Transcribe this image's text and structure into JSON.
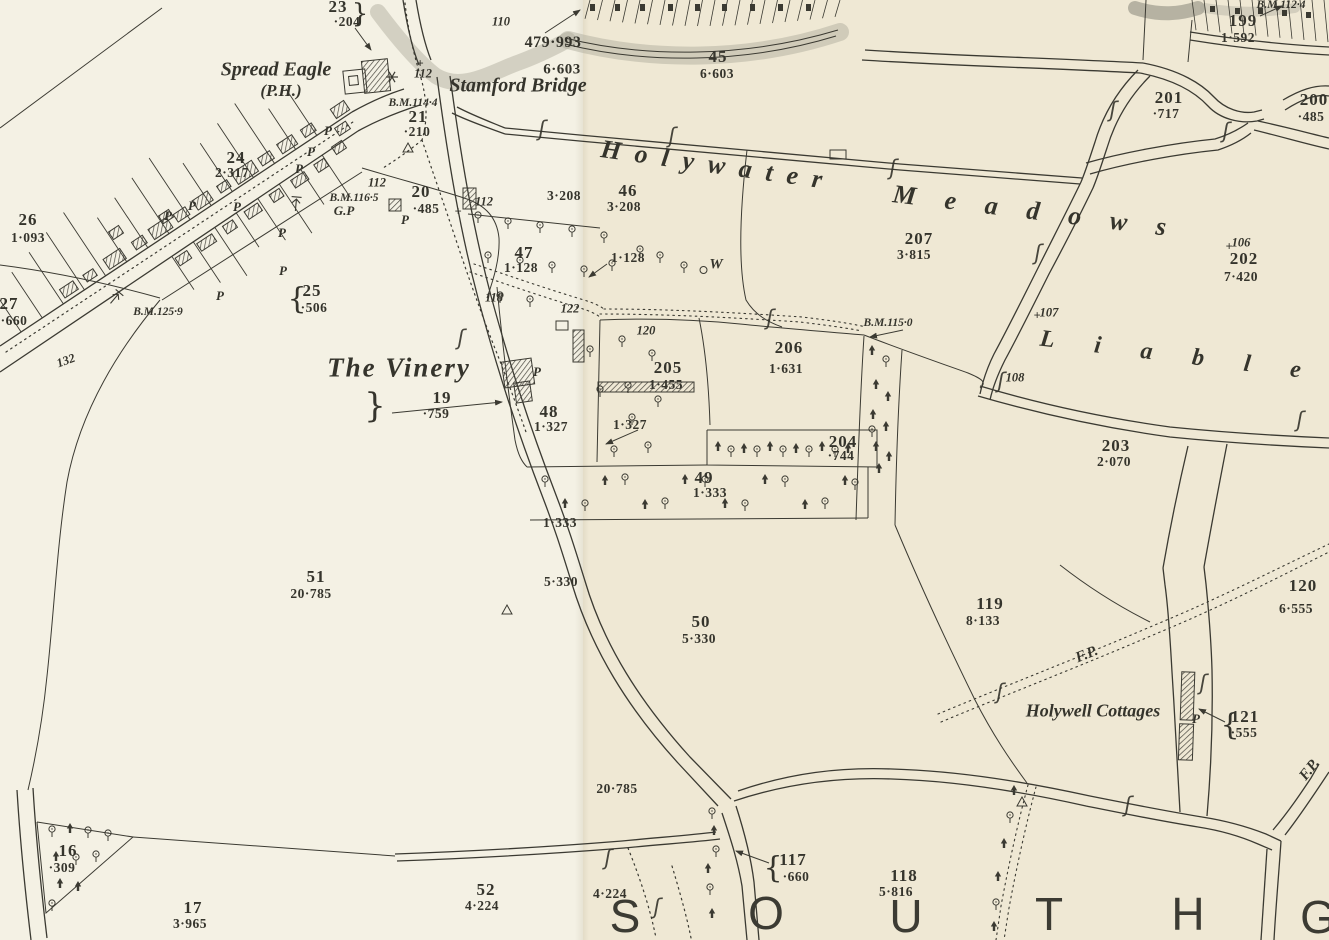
{
  "map": {
    "sheet_colors": {
      "left_paper": "#f4f1e4",
      "right_paper": "#efe8d4",
      "ink": "#3b3a32",
      "grey_wash": "#a9a79a"
    },
    "labels": [
      {
        "t": "23",
        "x": 338,
        "y": 7,
        "c": "parcel"
      },
      {
        "t": "·204",
        "x": 347,
        "y": 22,
        "c": "acre"
      },
      {
        "t": "}",
        "x": 360,
        "y": 14,
        "c": "brace"
      },
      {
        "t": "24",
        "x": 236,
        "y": 158,
        "c": "parcel"
      },
      {
        "t": "2·317",
        "x": 232,
        "y": 173,
        "c": "acre"
      },
      {
        "t": "26",
        "x": 28,
        "y": 220,
        "c": "parcel"
      },
      {
        "t": "1·093",
        "x": 28,
        "y": 238,
        "c": "acre"
      },
      {
        "t": "27",
        "x": 9,
        "y": 304,
        "c": "parcel"
      },
      {
        "t": "·660",
        "x": 14,
        "y": 321,
        "c": "acre"
      },
      {
        "t": "{",
        "x": 297,
        "y": 299,
        "c": "brace",
        "fs": 30
      },
      {
        "t": "25",
        "x": 312,
        "y": 291,
        "c": "parcel"
      },
      {
        "t": "·506",
        "x": 314,
        "y": 308,
        "c": "acre"
      },
      {
        "t": "21",
        "x": 418,
        "y": 117,
        "c": "parcel"
      },
      {
        "t": "·210",
        "x": 417,
        "y": 132,
        "c": "acre"
      },
      {
        "t": "20",
        "x": 421,
        "y": 192,
        "c": "parcel"
      },
      {
        "t": "·485",
        "x": 426,
        "y": 209,
        "c": "acre"
      },
      {
        "t": "19",
        "x": 442,
        "y": 398,
        "c": "parcel"
      },
      {
        "t": "·759",
        "x": 436,
        "y": 414,
        "c": "acre"
      },
      {
        "t": "}",
        "x": 375,
        "y": 406,
        "c": "brace",
        "fs": 34
      },
      {
        "t": "45",
        "x": 718,
        "y": 57,
        "c": "parcel"
      },
      {
        "t": "6·603",
        "x": 717,
        "y": 74,
        "c": "acre"
      },
      {
        "t": "46",
        "x": 628,
        "y": 191,
        "c": "parcel"
      },
      {
        "t": "3·208",
        "x": 624,
        "y": 207,
        "c": "acre"
      },
      {
        "t": "47",
        "x": 524,
        "y": 253,
        "c": "parcel"
      },
      {
        "t": "1·128",
        "x": 521,
        "y": 268,
        "c": "acre"
      },
      {
        "t": "48",
        "x": 549,
        "y": 412,
        "c": "parcel"
      },
      {
        "t": "1·327",
        "x": 551,
        "y": 427,
        "c": "acre"
      },
      {
        "t": "49",
        "x": 704,
        "y": 478,
        "c": "parcel"
      },
      {
        "t": "1·333",
        "x": 710,
        "y": 493,
        "c": "acre"
      },
      {
        "t": "50",
        "x": 701,
        "y": 622,
        "c": "parcel"
      },
      {
        "t": "5·330",
        "x": 699,
        "y": 639,
        "c": "acre"
      },
      {
        "t": "51",
        "x": 316,
        "y": 577,
        "c": "parcel"
      },
      {
        "t": "20·785",
        "x": 311,
        "y": 594,
        "c": "acre"
      },
      {
        "t": "52",
        "x": 486,
        "y": 890,
        "c": "parcel"
      },
      {
        "t": "4·224",
        "x": 482,
        "y": 906,
        "c": "acre"
      },
      {
        "t": "16",
        "x": 68,
        "y": 851,
        "c": "parcel"
      },
      {
        "t": "·309",
        "x": 62,
        "y": 868,
        "c": "acre"
      },
      {
        "t": "17",
        "x": 193,
        "y": 908,
        "c": "parcel"
      },
      {
        "t": "3·965",
        "x": 190,
        "y": 924,
        "c": "acre"
      },
      {
        "t": "{",
        "x": 773,
        "y": 868,
        "c": "brace",
        "fs": 30
      },
      {
        "t": "117",
        "x": 793,
        "y": 860,
        "c": "parcel"
      },
      {
        "t": "·660",
        "x": 796,
        "y": 877,
        "c": "acre"
      },
      {
        "t": "118",
        "x": 904,
        "y": 876,
        "c": "parcel"
      },
      {
        "t": "5·816",
        "x": 896,
        "y": 892,
        "c": "acre"
      },
      {
        "t": "119",
        "x": 990,
        "y": 604,
        "c": "parcel"
      },
      {
        "t": "8·133",
        "x": 983,
        "y": 621,
        "c": "acre"
      },
      {
        "t": "120",
        "x": 1303,
        "y": 586,
        "c": "parcel"
      },
      {
        "t": "6·555",
        "x": 1296,
        "y": 609,
        "c": "acre"
      },
      {
        "t": "{",
        "x": 1230,
        "y": 725,
        "c": "brace",
        "fs": 30
      },
      {
        "t": "121",
        "x": 1245,
        "y": 717,
        "c": "parcel"
      },
      {
        "t": "·555",
        "x": 1244,
        "y": 733,
        "c": "acre"
      },
      {
        "t": "199",
        "x": 1243,
        "y": 21,
        "c": "parcel"
      },
      {
        "t": "1·592",
        "x": 1238,
        "y": 38,
        "c": "acre"
      },
      {
        "t": "200",
        "x": 1314,
        "y": 100,
        "c": "parcel"
      },
      {
        "t": "·485",
        "x": 1311,
        "y": 117,
        "c": "acre"
      },
      {
        "t": "201",
        "x": 1169,
        "y": 98,
        "c": "parcel"
      },
      {
        "t": "·717",
        "x": 1166,
        "y": 114,
        "c": "acre"
      },
      {
        "t": "202",
        "x": 1244,
        "y": 259,
        "c": "parcel"
      },
      {
        "t": "7·420",
        "x": 1241,
        "y": 277,
        "c": "acre"
      },
      {
        "t": "203",
        "x": 1116,
        "y": 446,
        "c": "parcel"
      },
      {
        "t": "2·070",
        "x": 1114,
        "y": 462,
        "c": "acre"
      },
      {
        "t": "204",
        "x": 843,
        "y": 442,
        "c": "parcel"
      },
      {
        "t": "·744",
        "x": 841,
        "y": 456,
        "c": "acre"
      },
      {
        "t": "205",
        "x": 668,
        "y": 368,
        "c": "parcel"
      },
      {
        "t": "1·455",
        "x": 666,
        "y": 385,
        "c": "acre"
      },
      {
        "t": "206",
        "x": 789,
        "y": 348,
        "c": "parcel"
      },
      {
        "t": "1·631",
        "x": 786,
        "y": 369,
        "c": "acre"
      },
      {
        "t": "207",
        "x": 919,
        "y": 239,
        "c": "parcel"
      },
      {
        "t": "3·815",
        "x": 914,
        "y": 255,
        "c": "acre"
      },
      {
        "t": "479·993",
        "x": 553,
        "y": 43,
        "c": "acre",
        "fs": 16
      },
      {
        "t": "6·603",
        "x": 562,
        "y": 70,
        "c": "acre",
        "fs": 15
      },
      {
        "t": "3·208",
        "x": 564,
        "y": 196,
        "c": "acre"
      },
      {
        "t": "1·128",
        "x": 628,
        "y": 258,
        "c": "acre"
      },
      {
        "t": "1·327",
        "x": 630,
        "y": 425,
        "c": "acre"
      },
      {
        "t": "1·333",
        "x": 560,
        "y": 523,
        "c": "acre"
      },
      {
        "t": "5·330",
        "x": 561,
        "y": 582,
        "c": "acre"
      },
      {
        "t": "20·785",
        "x": 617,
        "y": 789,
        "c": "acre"
      },
      {
        "t": "4·224",
        "x": 610,
        "y": 894,
        "c": "acre"
      },
      {
        "t": "B.M.114·4",
        "x": 413,
        "y": 103,
        "c": "bm"
      },
      {
        "t": "B.M.116·5",
        "x": 354,
        "y": 198,
        "c": "bm"
      },
      {
        "t": "B.M.125·9",
        "x": 158,
        "y": 312,
        "c": "bm"
      },
      {
        "t": "B.M.115·0",
        "x": 888,
        "y": 323,
        "c": "bm"
      },
      {
        "t": "B.M.112·4",
        "x": 1281,
        "y": 5,
        "c": "bm"
      },
      {
        "t": "110",
        "x": 501,
        "y": 22,
        "c": "rd"
      },
      {
        "t": "112",
        "x": 423,
        "y": 74,
        "c": "rd"
      },
      {
        "t": "112",
        "x": 377,
        "y": 183,
        "c": "rd"
      },
      {
        "t": "112",
        "x": 484,
        "y": 202,
        "c": "rd"
      },
      {
        "t": "118",
        "x": 494,
        "y": 298,
        "c": "rd"
      },
      {
        "t": "122",
        "x": 570,
        "y": 309,
        "c": "rd"
      },
      {
        "t": "120",
        "x": 646,
        "y": 331,
        "c": "rd"
      },
      {
        "t": "132",
        "x": 66,
        "y": 361,
        "c": "rd",
        "r": -20
      },
      {
        "t": "106",
        "x": 1241,
        "y": 243,
        "c": "rd"
      },
      {
        "t": "107",
        "x": 1049,
        "y": 313,
        "c": "rd"
      },
      {
        "t": "108",
        "x": 1015,
        "y": 378,
        "c": "rd"
      },
      {
        "t": "+",
        "x": 1229,
        "y": 247,
        "c": "rd"
      },
      {
        "t": "+",
        "x": 1037,
        "y": 316,
        "c": "rd"
      },
      {
        "t": "+",
        "x": 458,
        "y": 212,
        "c": "rd"
      },
      {
        "t": "+",
        "x": 420,
        "y": 64,
        "c": "rd"
      },
      {
        "t": "Spread Eagle",
        "x": 276,
        "y": 70,
        "c": "place"
      },
      {
        "t": "(P.H.)",
        "x": 281,
        "y": 91,
        "c": "place",
        "fs": 17
      },
      {
        "t": "Stamford Bridge",
        "x": 518,
        "y": 86,
        "c": "place"
      },
      {
        "t": "The Vinery",
        "x": 399,
        "y": 368,
        "c": "place-lg"
      },
      {
        "t": "Holywell Cottages",
        "x": 1093,
        "y": 711,
        "c": "place",
        "fs": 18
      },
      {
        "t": "F.P.",
        "x": 1087,
        "y": 655,
        "c": "place-sm",
        "r": -22
      },
      {
        "t": "F.P.",
        "x": 1310,
        "y": 770,
        "c": "place-sm",
        "r": -52
      },
      {
        "t": "Holywater",
        "x": 601,
        "y": 149,
        "c": "spread",
        "a": "l",
        "r": 8,
        "ls": 14
      },
      {
        "t": "Meadows",
        "x": 893,
        "y": 194,
        "c": "spread",
        "a": "l",
        "r": 7,
        "ls": 29
      },
      {
        "t": "Liable",
        "x": 1040,
        "y": 339,
        "c": "spread",
        "a": "l",
        "r": 7,
        "ls": 40,
        "fs": 24
      },
      {
        "t": "S",
        "x": 625,
        "y": 916,
        "c": "huge"
      },
      {
        "t": "O",
        "x": 766,
        "y": 913,
        "c": "huge"
      },
      {
        "t": "U",
        "x": 906,
        "y": 916,
        "c": "huge"
      },
      {
        "t": "T",
        "x": 1049,
        "y": 914,
        "c": "huge"
      },
      {
        "t": "H",
        "x": 1188,
        "y": 914,
        "c": "huge"
      },
      {
        "t": "G",
        "x": 1318,
        "y": 917,
        "c": "huge"
      },
      {
        "t": "G.P",
        "x": 344,
        "y": 211,
        "c": "pmark"
      },
      {
        "t": "P",
        "x": 328,
        "y": 131,
        "c": "pmark"
      },
      {
        "t": "P",
        "x": 311,
        "y": 152,
        "c": "pmark"
      },
      {
        "t": "P",
        "x": 299,
        "y": 169,
        "c": "pmark"
      },
      {
        "t": "P",
        "x": 192,
        "y": 206,
        "c": "pmark"
      },
      {
        "t": "P",
        "x": 237,
        "y": 207,
        "c": "pmark"
      },
      {
        "t": "P",
        "x": 168,
        "y": 216,
        "c": "pmark"
      },
      {
        "t": "P",
        "x": 282,
        "y": 233,
        "c": "pmark"
      },
      {
        "t": "P",
        "x": 283,
        "y": 271,
        "c": "pmark"
      },
      {
        "t": "P",
        "x": 220,
        "y": 296,
        "c": "pmark"
      },
      {
        "t": "P",
        "x": 405,
        "y": 220,
        "c": "pmark"
      },
      {
        "t": "P",
        "x": 537,
        "y": 372,
        "c": "pmark"
      },
      {
        "t": "P",
        "x": 1196,
        "y": 719,
        "c": "pmark"
      },
      {
        "t": "W",
        "x": 716,
        "y": 265,
        "c": "pmark",
        "fs": 15
      },
      {
        "t": "ʃ",
        "x": 542,
        "y": 129,
        "c": "sect"
      },
      {
        "t": "ʃ",
        "x": 672,
        "y": 136,
        "c": "sect"
      },
      {
        "t": "ʃ",
        "x": 893,
        "y": 168,
        "c": "sect"
      },
      {
        "t": "ʃ",
        "x": 1113,
        "y": 110,
        "c": "sect"
      },
      {
        "t": "ʃ",
        "x": 1226,
        "y": 131,
        "c": "sect"
      },
      {
        "t": "ʃ",
        "x": 1038,
        "y": 253,
        "c": "sect"
      },
      {
        "t": "ʃ",
        "x": 1300,
        "y": 420,
        "c": "sect"
      },
      {
        "t": "ʃ",
        "x": 1000,
        "y": 692,
        "c": "sect"
      },
      {
        "t": "ʃ",
        "x": 1203,
        "y": 683,
        "c": "sect"
      },
      {
        "t": "ʃ",
        "x": 461,
        "y": 338,
        "c": "sect"
      },
      {
        "t": "ʃ",
        "x": 608,
        "y": 858,
        "c": "sect"
      },
      {
        "t": "ʃ",
        "x": 1128,
        "y": 805,
        "c": "sect"
      },
      {
        "t": "ʃ",
        "x": 657,
        "y": 907,
        "c": "sect"
      },
      {
        "t": "ʃ",
        "x": 770,
        "y": 318,
        "c": "sect"
      },
      {
        "t": "ʃ",
        "x": 1001,
        "y": 381,
        "c": "sect"
      }
    ]
  }
}
